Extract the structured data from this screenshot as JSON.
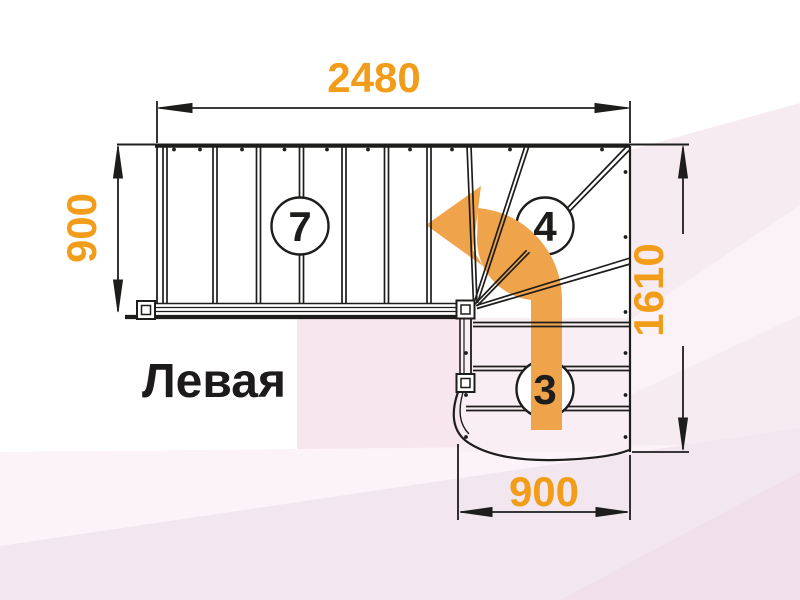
{
  "drawing": {
    "title_label": "Левая",
    "dimensions": {
      "top": "2480",
      "left": "900",
      "right": "1610",
      "bottom": "900"
    },
    "step_counts": {
      "upper_flight": "7",
      "winders": "4",
      "lower_flight": "3"
    },
    "colors": {
      "dimension_text": "#f19d1a",
      "arrow": "#efa34a",
      "line": "#1d1d1b",
      "label_text": "#1d1a1b"
    }
  }
}
